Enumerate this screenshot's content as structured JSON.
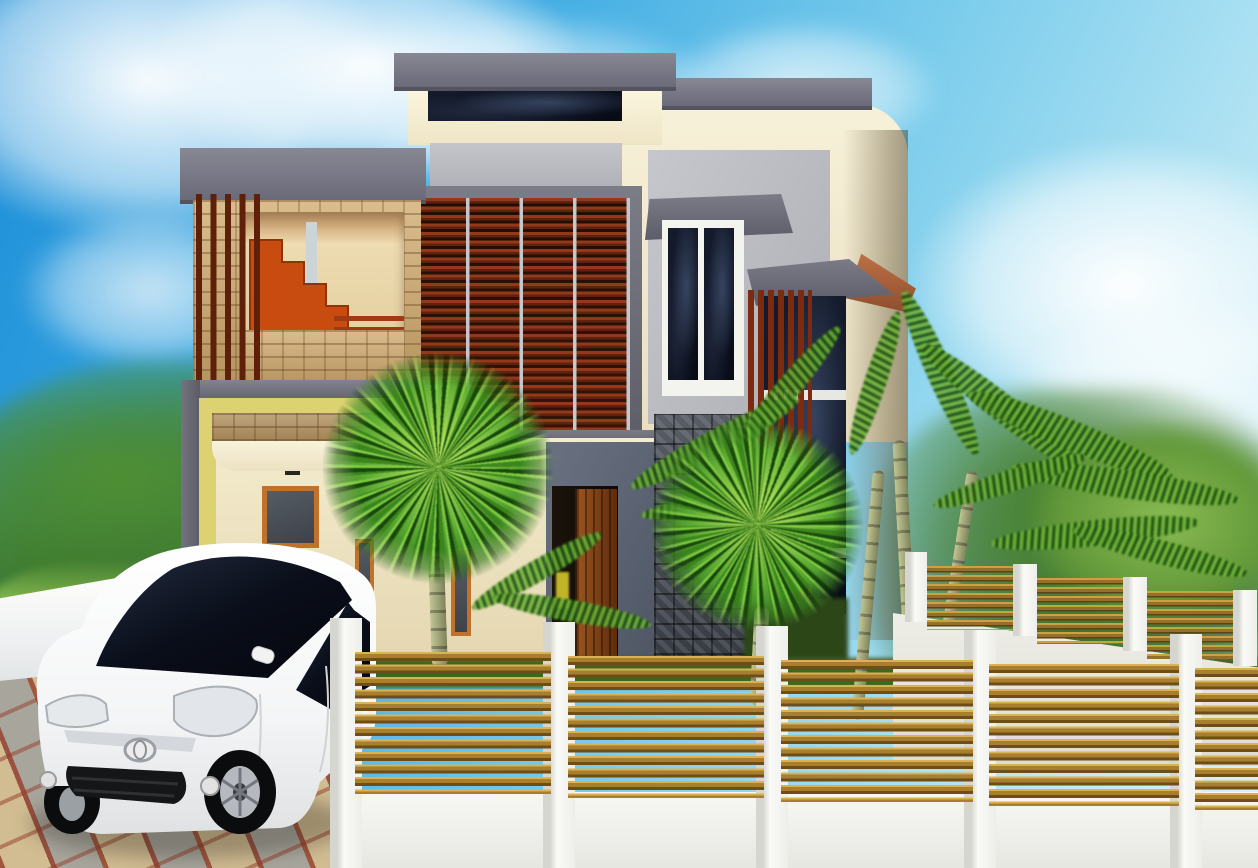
{
  "scene": {
    "type": "3d-architectural-exterior-render",
    "description": "Daylight 3D rendering of a modern two-storey tropical minimalist house with flat grey roof slabs, cream walls, wooden louvre screens, stone-clad balcony and column, a white Toyota MPV parked on a chequered paver driveway, fan and areca palms, and a white perimeter fence with horizontal timber slats under a blue sky with clouds.",
    "objects": [
      "blue-sky",
      "white-clouds",
      "background-tree-line",
      "grass-field",
      "two-storey-house",
      "flat-roof-slabs",
      "clerestory-window",
      "louvred-window",
      "stone-framed-balcony",
      "orange-staircase",
      "balcony-railing",
      "carport",
      "entrance-door",
      "stone-clad-column",
      "tall-window",
      "awnings",
      "vertical-timber-screens",
      "hip-roof-sliver",
      "white-toyota-mpv",
      "chequered-paver-driveway",
      "white-boundary-wall",
      "timber-slat-fence",
      "receding-side-fence",
      "fan-palms",
      "areca-palms"
    ],
    "text_content": "none"
  },
  "palette": {
    "sky_top": "#1d8ed8",
    "sky_light": "#b9e6f4",
    "cloud": "#ffffff",
    "roof_slab_gray": "#6a6a78",
    "wall_cream": "#f2ecd2",
    "panel_light_gray": "#bcbdc2",
    "glass_dark": "#0c1220",
    "louver_maroon": "#93391b",
    "stone_tan": "#c9a878",
    "stone_dark_gray": "#474c54",
    "accent_yellow": "#ddd272",
    "stair_orange": "#c84b10",
    "window_frame_orange": "#c0722c",
    "door_wood": "#7c3c12",
    "fence_white": "#f5f5f2",
    "fence_wood": "#a87f2e",
    "hedge_dark_green": "#22400f",
    "grass_green": "#7ab53a",
    "tree_green_dark": "#2e5d22",
    "paver_tan": "#d2bd93",
    "paver_gray": "#a8a69c",
    "paver_red": "#b05a40",
    "car_body": "#ffffff",
    "car_glass": "#0a0d14",
    "hip_roof_terracotta": "#b5673f"
  },
  "counts": {
    "front_fence_panels": 5,
    "front_fence_pillars": 5,
    "slats_per_panel": 11,
    "louver_columns": 4,
    "fan_palms": 2,
    "areca_trunks": 3
  }
}
